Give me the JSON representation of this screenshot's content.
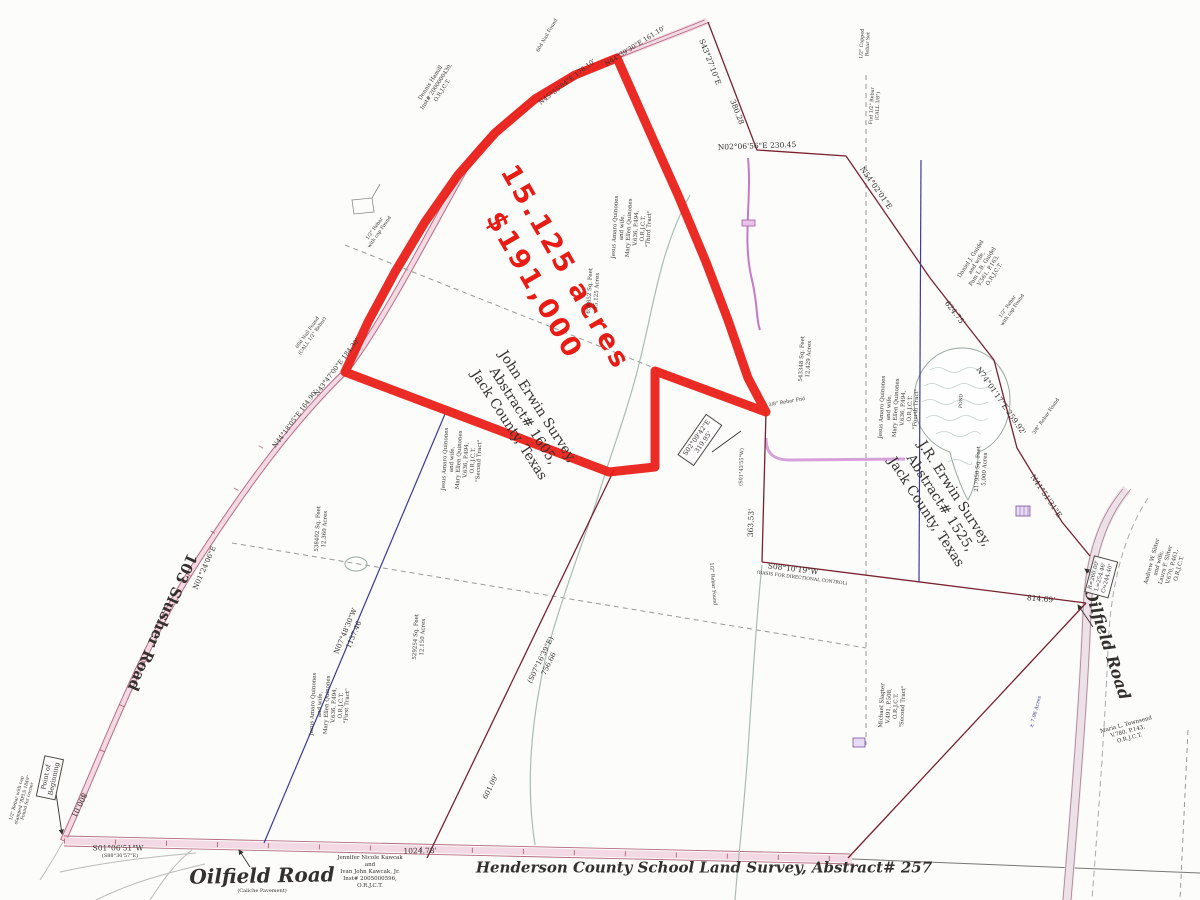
{
  "map": {
    "type": "land-survey-plat",
    "highlight": {
      "acreage": "15.125 acres",
      "price": "$191,000",
      "color": "#e81c15"
    },
    "colors": {
      "highlight_red": "#e81c15",
      "boundary_maroon": "#7a2030",
      "old_line_blue": "#3a3aa0",
      "dashed_gray": "#999999",
      "creek_gray": "#a8bdb2",
      "road_pink": "#f3d9e3",
      "pipeline_magenta": "#c878c8"
    },
    "labels": [
      {
        "id": "acreage-price",
        "text": "15.125 acres\n$191,000",
        "x": 549,
        "y": 277,
        "rot": 60,
        "size": 27,
        "color": "#e81c15",
        "bold": true,
        "sans": true,
        "ls": 3,
        "lh": 1.35
      },
      {
        "id": "john-erwin-survey",
        "text": "John Erwin Survey,\nAbstract# 1605,\nJack County, Texas",
        "x": 523,
        "y": 416,
        "rot": 57,
        "size": 13.5
      },
      {
        "id": "jr-erwin-survey",
        "text": "J.R. Erwin Survey,\nAbstract# 1525,\nJack County, Texas",
        "x": 940,
        "y": 503,
        "rot": 57,
        "size": 13.5
      },
      {
        "id": "henderson-survey",
        "text": "Henderson County School Land Survey, Abstract# 257",
        "x": 704,
        "y": 868,
        "rot": 0,
        "size": 15,
        "bold": true,
        "italic": true
      },
      {
        "id": "oilfield-road-bottom",
        "text": "Oilfield Road",
        "x": 262,
        "y": 876,
        "rot": -1,
        "size": 20,
        "bold": true,
        "italic": true
      },
      {
        "id": "oilfield-road-bottom-sub",
        "text": "(Caliche Pavement)",
        "x": 262,
        "y": 891,
        "rot": 0,
        "size": 5
      },
      {
        "id": "oilfield-road-right",
        "text": "Oilfield Road",
        "x": 1107,
        "y": 644,
        "rot": 72,
        "size": 16,
        "bold": true,
        "italic": true
      },
      {
        "id": "slusher-road",
        "text": "103 Slusher Road",
        "x": 162,
        "y": 622,
        "rot": 114,
        "size": 15,
        "bold": true
      },
      {
        "id": "point-of-beginning",
        "text": "Point of\nBeginning",
        "x": 50,
        "y": 778,
        "rot": -78,
        "size": 6.5,
        "boxed": true
      },
      {
        "id": "bearing-n02",
        "text": "N02°06'56\"E 230.45",
        "x": 757,
        "y": 146,
        "rot": -2,
        "size": 7.5
      },
      {
        "id": "bearing-n54",
        "text": "N54°02'01\"E",
        "x": 876,
        "y": 188,
        "rot": 55,
        "size": 7.5
      },
      {
        "id": "dist-380",
        "text": "380.28",
        "x": 737,
        "y": 112,
        "rot": 69,
        "size": 7.5
      },
      {
        "id": "bearing-s43",
        "text": "S43°27'10\"E",
        "x": 710,
        "y": 62,
        "rot": 69,
        "size": 7.5
      },
      {
        "id": "dist-624",
        "text": "624.75'",
        "x": 955,
        "y": 313,
        "rot": 52,
        "size": 7.5
      },
      {
        "id": "bearing-n74",
        "text": "N74°01'17\"E 259.92'",
        "x": 1001,
        "y": 401,
        "rot": 55,
        "size": 7.5
      },
      {
        "id": "bearing-n41",
        "text": "N41°51'31\"E",
        "x": 1046,
        "y": 496,
        "rot": 56,
        "size": 7.5
      },
      {
        "id": "dist-363",
        "text": "363.53'",
        "x": 751,
        "y": 523,
        "rot": -88,
        "size": 7.5
      },
      {
        "id": "call-s01-43",
        "text": "(S01°43'55\"W)",
        "x": 742,
        "y": 467,
        "rot": -88,
        "size": 5
      },
      {
        "id": "bearing-s08",
        "text": "S08°10'19\"W",
        "x": 793,
        "y": 569,
        "rot": 7,
        "size": 7.5
      },
      {
        "id": "bearing-s08-sub",
        "text": "(BASIS FOR DIRECTIONAL CONTROL)",
        "x": 802,
        "y": 579,
        "rot": 7,
        "size": 4.5
      },
      {
        "id": "dist-814",
        "text": "814.69'",
        "x": 1041,
        "y": 599,
        "rot": 5,
        "size": 7.5
      },
      {
        "id": "bearing-s01",
        "text": "S01°06'51\"W",
        "x": 118,
        "y": 848,
        "rot": 0,
        "size": 7.5
      },
      {
        "id": "bearing-s01-sub",
        "text": "(S88°30'57\"E)",
        "x": 120,
        "y": 856,
        "rot": 0,
        "size": 5
      },
      {
        "id": "dist-1024",
        "text": "1024.78'",
        "x": 420,
        "y": 851,
        "rot": -1,
        "size": 7.5
      },
      {
        "id": "dist-800",
        "text": "800.01",
        "x": 79,
        "y": 805,
        "rot": 116,
        "size": 7.5
      },
      {
        "id": "bearing-n01-24",
        "text": "N01°24'06\"E",
        "x": 205,
        "y": 568,
        "rot": -66,
        "size": 7
      },
      {
        "id": "bearing-n07-48",
        "text": "N07°48'30\"W\n1137.46",
        "x": 350,
        "y": 633,
        "rot": -67,
        "size": 7
      },
      {
        "id": "bearing-s07-16",
        "text": "(S07°16'39\"E)\n756.66",
        "x": 545,
        "y": 662,
        "rot": -64,
        "size": 7
      },
      {
        "id": "bearing-n44-18",
        "text": "N44°18'05\"E 164.90'",
        "x": 295,
        "y": 419,
        "rot": -53,
        "size": 6.5
      },
      {
        "id": "bearing-n43-47",
        "text": "N43°47'00\"E 184.30'",
        "x": 337,
        "y": 367,
        "rot": -53,
        "size": 6.5
      },
      {
        "id": "bearing-n44-39",
        "text": "N44°39'30\"E 161.10'",
        "x": 635,
        "y": 46,
        "rot": -32,
        "size": 6.5
      },
      {
        "id": "bearing-n45-55",
        "text": "N45°55'04\"E 178.10'",
        "x": 567,
        "y": 82,
        "rot": -38,
        "size": 6.5
      },
      {
        "id": "call-s02-09",
        "text": "S02°09'42\"E\n319.95'",
        "x": 700,
        "y": 440,
        "rot": -55,
        "size": 6.5,
        "boxed": true
      },
      {
        "id": "dist-601",
        "text": "601.09'",
        "x": 491,
        "y": 787,
        "rot": -64,
        "size": 7
      },
      {
        "id": "pond-label",
        "text": "POND",
        "x": 962,
        "y": 401,
        "rot": -87,
        "size": 4.5
      },
      {
        "id": "owner-quinones-third",
        "text": "Jesus Amaro Quinones\nand wife,\nMary Ellen Quinones\nV.636, P.494,\nO.R.J.C.T.\n\"Third Tract\"",
        "x": 633,
        "y": 228,
        "rot": -87,
        "size": 5.5
      },
      {
        "id": "area-15125",
        "text": "658852 Sq. Feet\n15.125 Acres",
        "x": 594,
        "y": 291,
        "rot": -87,
        "size": 5.5
      },
      {
        "id": "owner-quinones-fourth",
        "text": "Jesus Amaro Quinones\nand wife,\nMary Ellen Quinones\nV.636, P.494,\nO.R.J.C.T.\n\"Fourth Tract\"",
        "x": 900,
        "y": 408,
        "rot": -87,
        "size": 5.5
      },
      {
        "id": "owner-quinones-second",
        "text": "Jesus Amaro Quinones\nand wife,\nMary Ellen Quinones\nV.636, P.494,\nO.R.J.C.T.\n\"Second Tract\"",
        "x": 463,
        "y": 460,
        "rot": -87,
        "size": 5.5
      },
      {
        "id": "owner-quinones-first",
        "text": "Jesus Amaro Quinones\nand wife,\nMary Ellen Quinones\nV.636, P.494,\nO.R.J.C.T.\n\"First Tract\"",
        "x": 331,
        "y": 705,
        "rot": -87,
        "size": 5.5
      },
      {
        "id": "area-12360",
        "text": "538402 Sq. Feet\n12.360 Acres",
        "x": 322,
        "y": 529,
        "rot": -87,
        "size": 5.5
      },
      {
        "id": "area-12150",
        "text": "529254 Sq. Feet\n12.150 Acres",
        "x": 420,
        "y": 637,
        "rot": -87,
        "size": 5.5
      },
      {
        "id": "area-12429",
        "text": "543348 Sq. Feet\n12.429 Acres",
        "x": 806,
        "y": 359,
        "rot": -87,
        "size": 5.5
      },
      {
        "id": "area-5000",
        "text": "217950 Sq. Feet\n5.000 Acres",
        "x": 982,
        "y": 469,
        "rot": -87,
        "size": 5.5
      },
      {
        "id": "owner-guidel",
        "text": "Daniel J. Guidel\nand wife,\nPam L.B. Guidel\nV.561, P.163,\nO.R.J.C.T.",
        "x": 983,
        "y": 267,
        "rot": -57,
        "size": 5.5
      },
      {
        "id": "owner-hamill",
        "text": "Dennis Hamill\nInst# 2000000430,\nO.R.J.C.T.",
        "x": 437,
        "y": 87,
        "rot": -57,
        "size": 5.5
      },
      {
        "id": "owner-sliter",
        "text": "Andrew W. Sliter\nand wife,\nLaura F. Sliter\nV.670, P.461,\nO.R.J.C.T.",
        "x": 1166,
        "y": 565,
        "rot": -75,
        "size": 5.5
      },
      {
        "id": "owner-townsend",
        "text": "Maria L. Townsend\nV.780, P.143,\nO.R.J.C.T.",
        "x": 1128,
        "y": 732,
        "rot": -15,
        "size": 5.5
      },
      {
        "id": "owner-kawcak",
        "text": "Jennifer Nicole Kawcak\nand\nIvan John Kawcak, Jr.\nInst# 2005000596,\nO.R.J.C.T.",
        "x": 370,
        "y": 872,
        "rot": 0,
        "size": 5.5
      },
      {
        "id": "owner-slagter-second",
        "text": "Michael Slagter\nV.491, P.508,\nO.R.J.C.T.\n\"Second Tract\"",
        "x": 893,
        "y": 706,
        "rot": -87,
        "size": 5.5
      },
      {
        "id": "area-706",
        "text": "± 7.06 Acres",
        "x": 1036,
        "y": 712,
        "rot": -75,
        "size": 5,
        "color": "#3a3aa0"
      },
      {
        "id": "monument-rebar-1",
        "text": "1/2\" Rebar\nwith cap Found",
        "x": 378,
        "y": 231,
        "rot": -55,
        "size": 4.8
      },
      {
        "id": "monument-nail-1",
        "text": "60d Nail Found\n(CALL 1/2\" Rebar)",
        "x": 311,
        "y": 335,
        "rot": -55,
        "size": 4.8
      },
      {
        "id": "monument-rebar-top",
        "text": "1/2\" Capped\nRebar Set",
        "x": 866,
        "y": 44,
        "rot": -87,
        "size": 4.8
      },
      {
        "id": "monument-rebar-top2",
        "text": "Fnd 1/2\" Rebar\n(CALL 3/8\")",
        "x": 876,
        "y": 106,
        "rot": -87,
        "size": 4.8
      },
      {
        "id": "monument-rebar-2",
        "text": "1/2\" Rebar\nwith cap Found",
        "x": 1011,
        "y": 309,
        "rot": -55,
        "size": 4.8
      },
      {
        "id": "monument-rebar-3",
        "text": "3/8\" Rebar Found",
        "x": 1047,
        "y": 417,
        "rot": -55,
        "size": 4.8
      },
      {
        "id": "monument-rebar-4",
        "text": "3/8\" Rebar Fnd",
        "x": 787,
        "y": 403,
        "rot": -10,
        "size": 4.8
      },
      {
        "id": "monument-rebar-5",
        "text": "1/2\" Rebar Found",
        "x": 712,
        "y": 584,
        "rot": 85,
        "size": 4.8
      },
      {
        "id": "monument-rebar-pob",
        "text": "1/2\" Rebar with cap\nstamped \"RPLS 1849\"\nFound for corner",
        "x": 23,
        "y": 800,
        "rot": -75,
        "size": 4.5
      },
      {
        "id": "monument-nail-top",
        "text": "60d Nail Found",
        "x": 548,
        "y": 36,
        "rot": -60,
        "size": 4.8
      },
      {
        "id": "curve-data",
        "text": "R=260.00'\nL=254.46'\nC=244.40'",
        "x": 1101,
        "y": 577,
        "rot": -75,
        "size": 5.5,
        "boxed": true
      }
    ]
  }
}
